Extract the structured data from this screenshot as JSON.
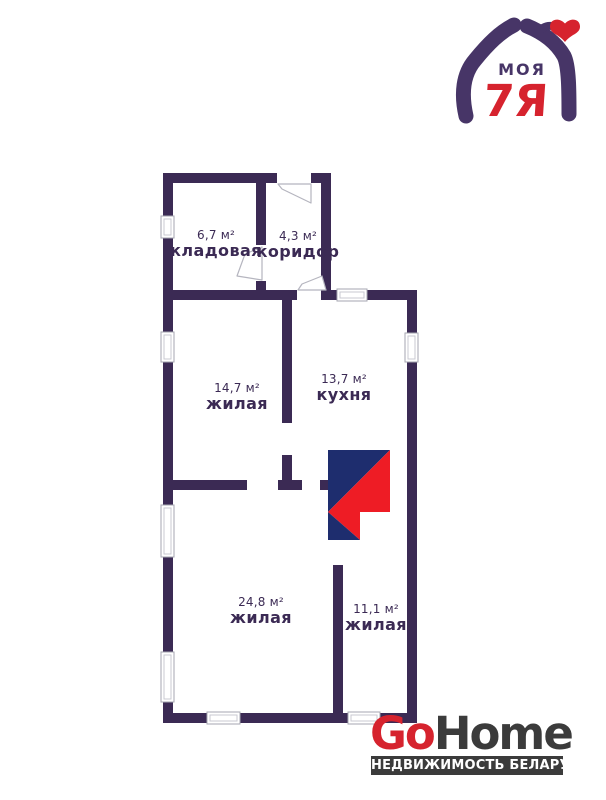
{
  "colors": {
    "wall": "#3b2a54",
    "room-text": "#3b2a54",
    "stove-navy": "#1e2d6e",
    "stove-red": "#ee1c25",
    "brand-red": "#d6232e",
    "brand-purple": "#473567",
    "gohome-dark": "#3b3b3b",
    "window-stroke": "#a6a6b0",
    "door-stroke": "#b5b5bf"
  },
  "top_logo": {
    "word": "МОЯ",
    "word2": "7Я"
  },
  "floorplan": {
    "rooms": [
      {
        "name": "кладовая",
        "area": "6,7 м²"
      },
      {
        "name": "коридор",
        "area": "4,3 м²"
      },
      {
        "name": "жилая",
        "area": "14,7 м²"
      },
      {
        "name": "кухня",
        "area": "13,7 м²"
      },
      {
        "name": "жилая",
        "area": "24,8 м²"
      },
      {
        "name": "жилая",
        "area": "11,1 м²"
      }
    ]
  },
  "bottom_logo": {
    "go": "Go",
    "home": "Home",
    "tagline": "НЕДВИЖИМОСТЬ БЕЛАРУСИ"
  }
}
